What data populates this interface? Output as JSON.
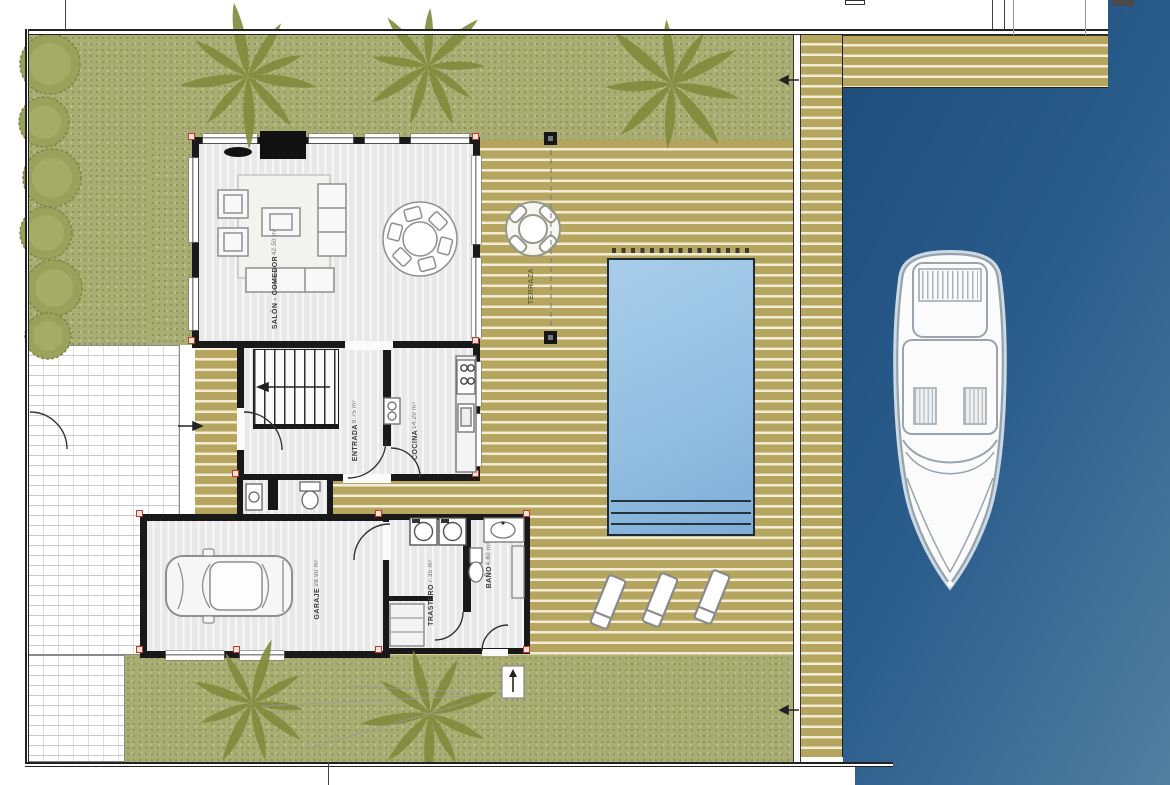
{
  "plan": {
    "rooms": {
      "living": {
        "name": "SALÓN - COMEDOR",
        "area": "42.50 m²"
      },
      "terrace": {
        "name": "TERRAZA"
      },
      "hall": {
        "name": "ENTRADA",
        "area": "8.75 m²"
      },
      "kitchen": {
        "name": "COCINA",
        "area": "14.20 m²"
      },
      "garage": {
        "name": "GARAJE",
        "area": "28.90 m²"
      },
      "storage": {
        "name": "TRASTERO",
        "area": "7.35 m²"
      },
      "bathroom": {
        "name": "BAÑO",
        "area": "4.80 m²"
      }
    },
    "colors": {
      "water": "#2a5c8c",
      "deck_wood": "#b6a55f",
      "grass": "#a8ad74",
      "pool": "#94bfe0",
      "wall": "#191919",
      "corner_marker": "#c0392b",
      "palm": "#818c3e"
    }
  }
}
